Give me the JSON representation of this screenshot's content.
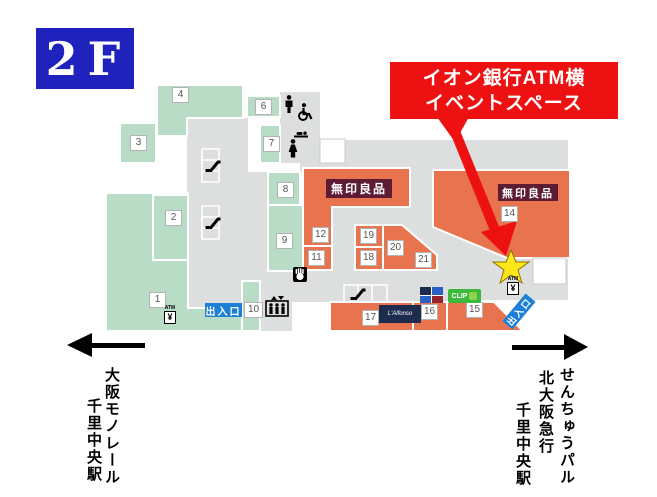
{
  "floor_label": "2F",
  "callout": {
    "line1": "イオン銀行ATM横",
    "line2": "イベントスペース"
  },
  "map": {
    "muji_label": "無印良品",
    "entrance_label": "出入口",
    "atm": {
      "label": "ATM",
      "yen": "¥"
    },
    "units": {
      "u1": "1",
      "u2": "2",
      "u3": "3",
      "u4": "4",
      "u6": "6",
      "u7": "7",
      "u8": "8",
      "u9": "9",
      "u10": "10",
      "u11": "11",
      "u12": "12",
      "u14": "14",
      "u15": "15",
      "u16": "16",
      "u17": "17",
      "u18": "18",
      "u19": "19",
      "u20": "20",
      "u21": "21"
    },
    "logos": {
      "unit17": "L'Alfonso",
      "unit15": "CLIP"
    },
    "icons": {
      "star": "event-space-location",
      "restrooms": [
        "men-restroom",
        "wheelchair-accessible",
        "baby-changing",
        "women-restroom"
      ],
      "transport": [
        "escalator",
        "escalator",
        "escalator",
        "elevator"
      ],
      "services": [
        "atm",
        "atm",
        "service-hand"
      ]
    }
  },
  "directions": {
    "left": {
      "line1": "大阪モノレール",
      "line2": "千里中央駅"
    },
    "right": {
      "line1": "せんちゅうパル",
      "line2": "北大阪急行",
      "line3": "千里中央駅"
    }
  },
  "colors": {
    "floor_blue": "#1f22bd",
    "accent_red": "#ee1111",
    "area_green": "#b8dcc6",
    "corridor_gray": "#dcdfde",
    "tenant_orange": "#e8744f",
    "muji_maroon": "#5e1b34",
    "entrance_blue": "#1d7fd6",
    "star_yellow": "#ffe61a"
  }
}
